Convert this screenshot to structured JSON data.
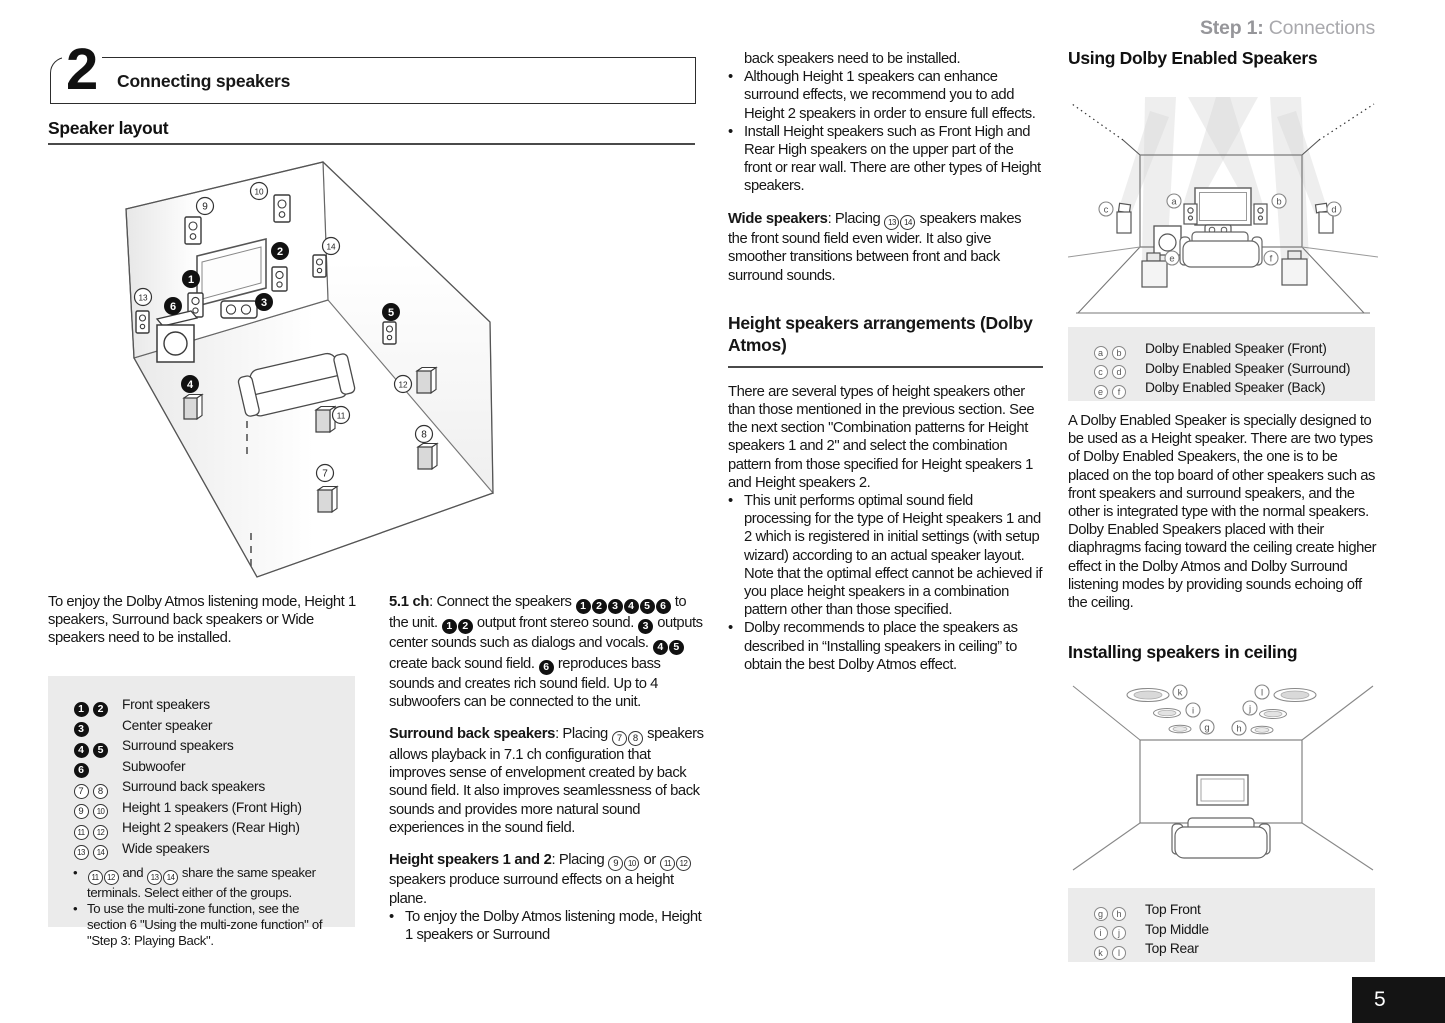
{
  "page": {
    "step_label": "Step 1:",
    "step_title": " Connections",
    "section_number": "2",
    "section_title": "Connecting speakers",
    "page_number": "5"
  },
  "col1": {
    "heading": "Speaker layout",
    "intro": "To enjoy the Dolby Atmos listening mode, Height 1 speakers, Surround back speakers or Wide speakers need to be installed.",
    "legend": {
      "rows": [
        {
          "markers": "{b1} {b2}",
          "label": "Front speakers"
        },
        {
          "markers": "{b3}",
          "label": "Center speaker"
        },
        {
          "markers": "{b4} {b5}",
          "label": "Surround speakers"
        },
        {
          "markers": "{b6}",
          "label": "Subwoofer"
        },
        {
          "markers": "{w7} {w8}",
          "label": "Surround back speakers"
        },
        {
          "markers": "{w9} {w10}",
          "label": "Height 1 speakers (Front High)"
        },
        {
          "markers": "{w11} {w12}",
          "label": "Height 2 speakers (Rear High)"
        },
        {
          "markers": "{w13} {w14}",
          "label": "Wide speakers"
        }
      ],
      "notes": [
        "{w11}{w12} and {w13}{w14} share the same speaker terminals. Select either of the groups.",
        "To use the multi-zone function, see the section 6 \"Using the multi-zone function\" of \"Step 3: Playing Back\"."
      ]
    }
  },
  "col2": {
    "para1": "**5.1 ch**: Connect the speakers {b1}{b2}{b3}{b4}{b5}{b6} to the unit. {b1}{b2} output front stereo sound. {b3} outputs center sounds such as dialogs and vocals. {b4}{b5} create back sound field. {b6} reproduces bass sounds and creates rich sound field. Up to 4 subwoofers can be connected to the unit.",
    "para2": "**Surround back speakers**: Placing {w7}{w8} speakers allows playback in 7.1 ch configuration that improves sense of envelopment created by back sound field. It also improves seamlessness of back sounds and provides more natural sound experiences in the sound field.",
    "para3": "**Height speakers 1 and 2**: Placing {w9}{w10} or {w11}{w12} speakers produce surround effects on a height plane.",
    "bullet": "To enjoy the Dolby Atmos listening mode, Height 1 speakers or Surround"
  },
  "col3": {
    "continuation": "back speakers need to be installed.",
    "bullets": [
      "Although Height 1 speakers can enhance surround effects, we recommend you to add Height 2 speakers in order to ensure full effects.",
      "Install Height speakers such as Front High and Rear High speakers on the upper part of the front or rear wall. There are other types of Height speakers."
    ],
    "wide_para": "**Wide speakers**: Placing {w13}{w14} speakers makes the front sound field even wider. It also give smoother transitions between front and back surround sounds.",
    "heading": "Height speakers arrangements (Dolby Atmos)",
    "para": "There are several types of height speakers other than those mentioned in the previous section. See the next section \"Combination patterns for Height speakers 1 and 2\" and select the combination pattern from those specified for Height speakers 1 and Height speakers 2.",
    "bullets2": [
      "This unit performs optimal sound field processing for the type of Height speakers 1 and 2 which is registered in initial settings (with setup wizard) according to an actual speaker layout. Note that the optimal effect cannot be achieved if you place height speakers in a combination pattern other than those specified.",
      "Dolby recommends to place the speakers as described in “Installing speakers in ceiling” to obtain the best Dolby Atmos effect."
    ]
  },
  "col4": {
    "heading1": "Using Dolby Enabled Speakers",
    "legend1": [
      {
        "markers": "{la} {lb}",
        "label": "Dolby Enabled Speaker (Front)"
      },
      {
        "markers": "{lc} {ld}",
        "label": "Dolby Enabled Speaker (Surround)"
      },
      {
        "markers": "{le} {lf}",
        "label": "Dolby Enabled Speaker (Back)"
      }
    ],
    "para": "A Dolby Enabled Speaker is specially designed to be used as a Height speaker. There are two types of Dolby Enabled Speakers, the one is to be placed on the top board of other speakers such as front speakers and surround speakers, and the other is integrated type with the normal speakers. Dolby Enabled Speakers placed with their diaphragms facing toward the ceiling create higher effect in the Dolby Atmos and Dolby Surround listening modes by providing sounds echoing off the ceiling.",
    "heading2": "Installing speakers in ceiling",
    "legend2": [
      {
        "markers": "{lg} {lh}",
        "label": "Top Front"
      },
      {
        "markers": "{li} {lj}",
        "label": "Top Middle"
      },
      {
        "markers": "{lk} {ll}",
        "label": "Top Rear"
      }
    ]
  },
  "diagram_main": {
    "badges": [
      {
        "t": "w",
        "n": "9",
        "x": 160,
        "y": 51
      },
      {
        "t": "w",
        "n": "10",
        "x": 214,
        "y": 36
      },
      {
        "t": "b",
        "n": "2",
        "x": 235,
        "y": 96
      },
      {
        "t": "w",
        "n": "14",
        "x": 286,
        "y": 91
      },
      {
        "t": "b",
        "n": "1",
        "x": 146,
        "y": 124
      },
      {
        "t": "w",
        "n": "13",
        "x": 98,
        "y": 142
      },
      {
        "t": "b",
        "n": "6",
        "x": 128,
        "y": 151
      },
      {
        "t": "b",
        "n": "3",
        "x": 219,
        "y": 147
      },
      {
        "t": "b",
        "n": "5",
        "x": 346,
        "y": 157
      },
      {
        "t": "b",
        "n": "4",
        "x": 145,
        "y": 229
      },
      {
        "t": "w",
        "n": "12",
        "x": 358,
        "y": 229
      },
      {
        "t": "w",
        "n": "11",
        "x": 296,
        "y": 260
      },
      {
        "t": "w",
        "n": "8",
        "x": 379,
        "y": 279
      },
      {
        "t": "w",
        "n": "7",
        "x": 280,
        "y": 318
      }
    ]
  },
  "diagram_enabled": {
    "badges": [
      {
        "t": "l",
        "n": "a",
        "x": 106,
        "y": 114
      },
      {
        "t": "l",
        "n": "b",
        "x": 211,
        "y": 114
      },
      {
        "t": "l",
        "n": "c",
        "x": 38,
        "y": 122
      },
      {
        "t": "l",
        "n": "d",
        "x": 266,
        "y": 122
      },
      {
        "t": "l",
        "n": "e",
        "x": 104,
        "y": 171
      },
      {
        "t": "l",
        "n": "f",
        "x": 203,
        "y": 171
      }
    ]
  },
  "diagram_ceiling": {
    "badges": [
      {
        "t": "l",
        "n": "k",
        "x": 112,
        "y": 14
      },
      {
        "t": "l",
        "n": "l",
        "x": 194,
        "y": 14
      },
      {
        "t": "l",
        "n": "i",
        "x": 125,
        "y": 32
      },
      {
        "t": "l",
        "n": "j",
        "x": 182,
        "y": 30
      },
      {
        "t": "l",
        "n": "g",
        "x": 139,
        "y": 49
      },
      {
        "t": "l",
        "n": "h",
        "x": 171,
        "y": 50
      }
    ]
  }
}
